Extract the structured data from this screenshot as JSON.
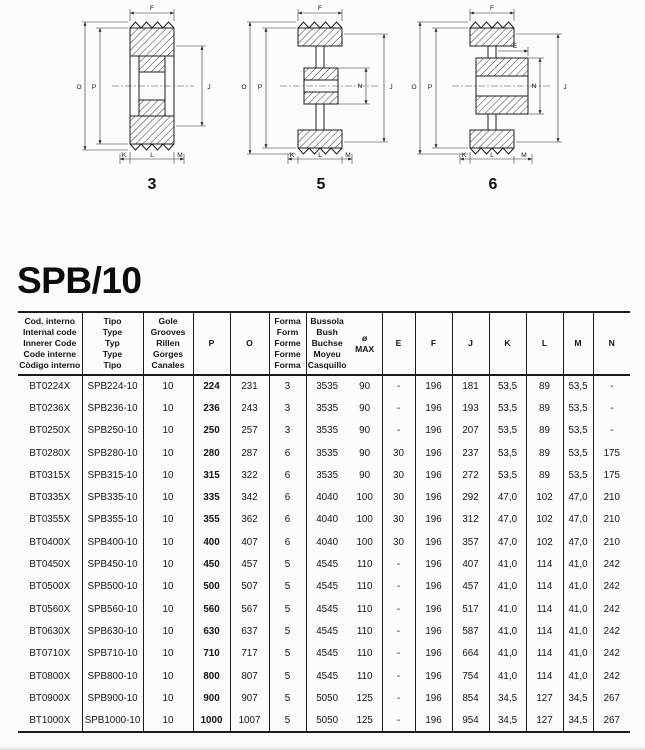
{
  "title": "SPB/10",
  "diagrams": [
    {
      "number": "3",
      "labels": {
        "f": "F",
        "o": "O",
        "p": "P",
        "j": "J",
        "k": "K",
        "l": "L",
        "m": "M"
      }
    },
    {
      "number": "5",
      "labels": {
        "f": "F",
        "o": "O",
        "p": "P",
        "n": "N",
        "j": "J",
        "k": "K",
        "l": "L",
        "m": "M"
      }
    },
    {
      "number": "6",
      "labels": {
        "f": "F",
        "e": "E",
        "o": "O",
        "p": "P",
        "n": "N",
        "j": "J",
        "k": "K",
        "l": "L",
        "m": "M"
      }
    }
  ],
  "table": {
    "columns": [
      {
        "key": "code",
        "lines": [
          "Cod. interno",
          "Internal code",
          "Innerer Code",
          "Code interne",
          "Còdigo interno"
        ]
      },
      {
        "key": "type",
        "lines": [
          "Tipo",
          "Type",
          "Typ",
          "Type",
          "Tipo"
        ]
      },
      {
        "key": "grooves",
        "lines": [
          "Gole",
          "Grooves",
          "Rillen",
          "Gorges",
          "Canales"
        ]
      },
      {
        "key": "P",
        "lines": [
          "P"
        ]
      },
      {
        "key": "O",
        "lines": [
          "O"
        ]
      },
      {
        "key": "form",
        "lines": [
          "Forma",
          "Form",
          "Forme",
          "Forme",
          "Forma"
        ]
      },
      {
        "key": "bush",
        "lines": [
          "Bussola",
          "Bush",
          "Buchse",
          "Moyeu",
          "Casquillo"
        ],
        "lines2": [
          "ø",
          "MAX"
        ],
        "split": true
      },
      {
        "key": "E",
        "lines": [
          "E"
        ]
      },
      {
        "key": "F",
        "lines": [
          "F"
        ]
      },
      {
        "key": "J",
        "lines": [
          "J"
        ]
      },
      {
        "key": "K",
        "lines": [
          "K"
        ]
      },
      {
        "key": "L",
        "lines": [
          "L"
        ]
      },
      {
        "key": "M",
        "lines": [
          "M"
        ]
      },
      {
        "key": "N",
        "lines": [
          "N"
        ]
      }
    ],
    "rows": [
      [
        "BT0224X",
        "SPB224-10",
        "10",
        "224",
        "231",
        "3",
        "3535",
        "90",
        "-",
        "196",
        "181",
        "53,5",
        "89",
        "53,5",
        "-"
      ],
      [
        "BT0236X",
        "SPB236-10",
        "10",
        "236",
        "243",
        "3",
        "3535",
        "90",
        "-",
        "196",
        "193",
        "53,5",
        "89",
        "53,5",
        "-"
      ],
      [
        "BT0250X",
        "SPB250-10",
        "10",
        "250",
        "257",
        "3",
        "3535",
        "90",
        "-",
        "196",
        "207",
        "53,5",
        "89",
        "53,5",
        "-"
      ],
      [
        "BT0280X",
        "SPB280-10",
        "10",
        "280",
        "287",
        "6",
        "3535",
        "90",
        "30",
        "196",
        "237",
        "53,5",
        "89",
        "53,5",
        "175"
      ],
      [
        "BT0315X",
        "SPB315-10",
        "10",
        "315",
        "322",
        "6",
        "3535",
        "90",
        "30",
        "196",
        "272",
        "53,5",
        "89",
        "53,5",
        "175"
      ],
      [
        "BT0335X",
        "SPB335-10",
        "10",
        "335",
        "342",
        "6",
        "4040",
        "100",
        "30",
        "196",
        "292",
        "47,0",
        "102",
        "47,0",
        "210"
      ],
      [
        "BT0355X",
        "SPB355-10",
        "10",
        "355",
        "362",
        "6",
        "4040",
        "100",
        "30",
        "196",
        "312",
        "47,0",
        "102",
        "47,0",
        "210"
      ],
      [
        "BT0400X",
        "SPB400-10",
        "10",
        "400",
        "407",
        "6",
        "4040",
        "100",
        "30",
        "196",
        "357",
        "47,0",
        "102",
        "47,0",
        "210"
      ],
      [
        "BT0450X",
        "SPB450-10",
        "10",
        "450",
        "457",
        "5",
        "4545",
        "110",
        "-",
        "196",
        "407",
        "41,0",
        "114",
        "41,0",
        "242"
      ],
      [
        "BT0500X",
        "SPB500-10",
        "10",
        "500",
        "507",
        "5",
        "4545",
        "110",
        "-",
        "196",
        "457",
        "41,0",
        "114",
        "41,0",
        "242"
      ],
      [
        "BT0560X",
        "SPB560-10",
        "10",
        "560",
        "567",
        "5",
        "4545",
        "110",
        "-",
        "196",
        "517",
        "41,0",
        "114",
        "41,0",
        "242"
      ],
      [
        "BT0630X",
        "SPB630-10",
        "10",
        "630",
        "637",
        "5",
        "4545",
        "110",
        "-",
        "196",
        "587",
        "41,0",
        "114",
        "41,0",
        "242"
      ],
      [
        "BT0710X",
        "SPB710-10",
        "10",
        "710",
        "717",
        "5",
        "4545",
        "110",
        "-",
        "196",
        "664",
        "41,0",
        "114",
        "41,0",
        "242"
      ],
      [
        "BT0800X",
        "SPB800-10",
        "10",
        "800",
        "807",
        "5",
        "4545",
        "110",
        "-",
        "196",
        "754",
        "41,0",
        "114",
        "41,0",
        "242"
      ],
      [
        "BT0900X",
        "SPB900-10",
        "10",
        "900",
        "907",
        "5",
        "5050",
        "125",
        "-",
        "196",
        "854",
        "34,5",
        "127",
        "34,5",
        "267"
      ],
      [
        "BT1000X",
        "SPB1000-10",
        "10",
        "1000",
        "1007",
        "5",
        "5050",
        "125",
        "-",
        "196",
        "954",
        "34,5",
        "127",
        "34,5",
        "267"
      ]
    ]
  }
}
